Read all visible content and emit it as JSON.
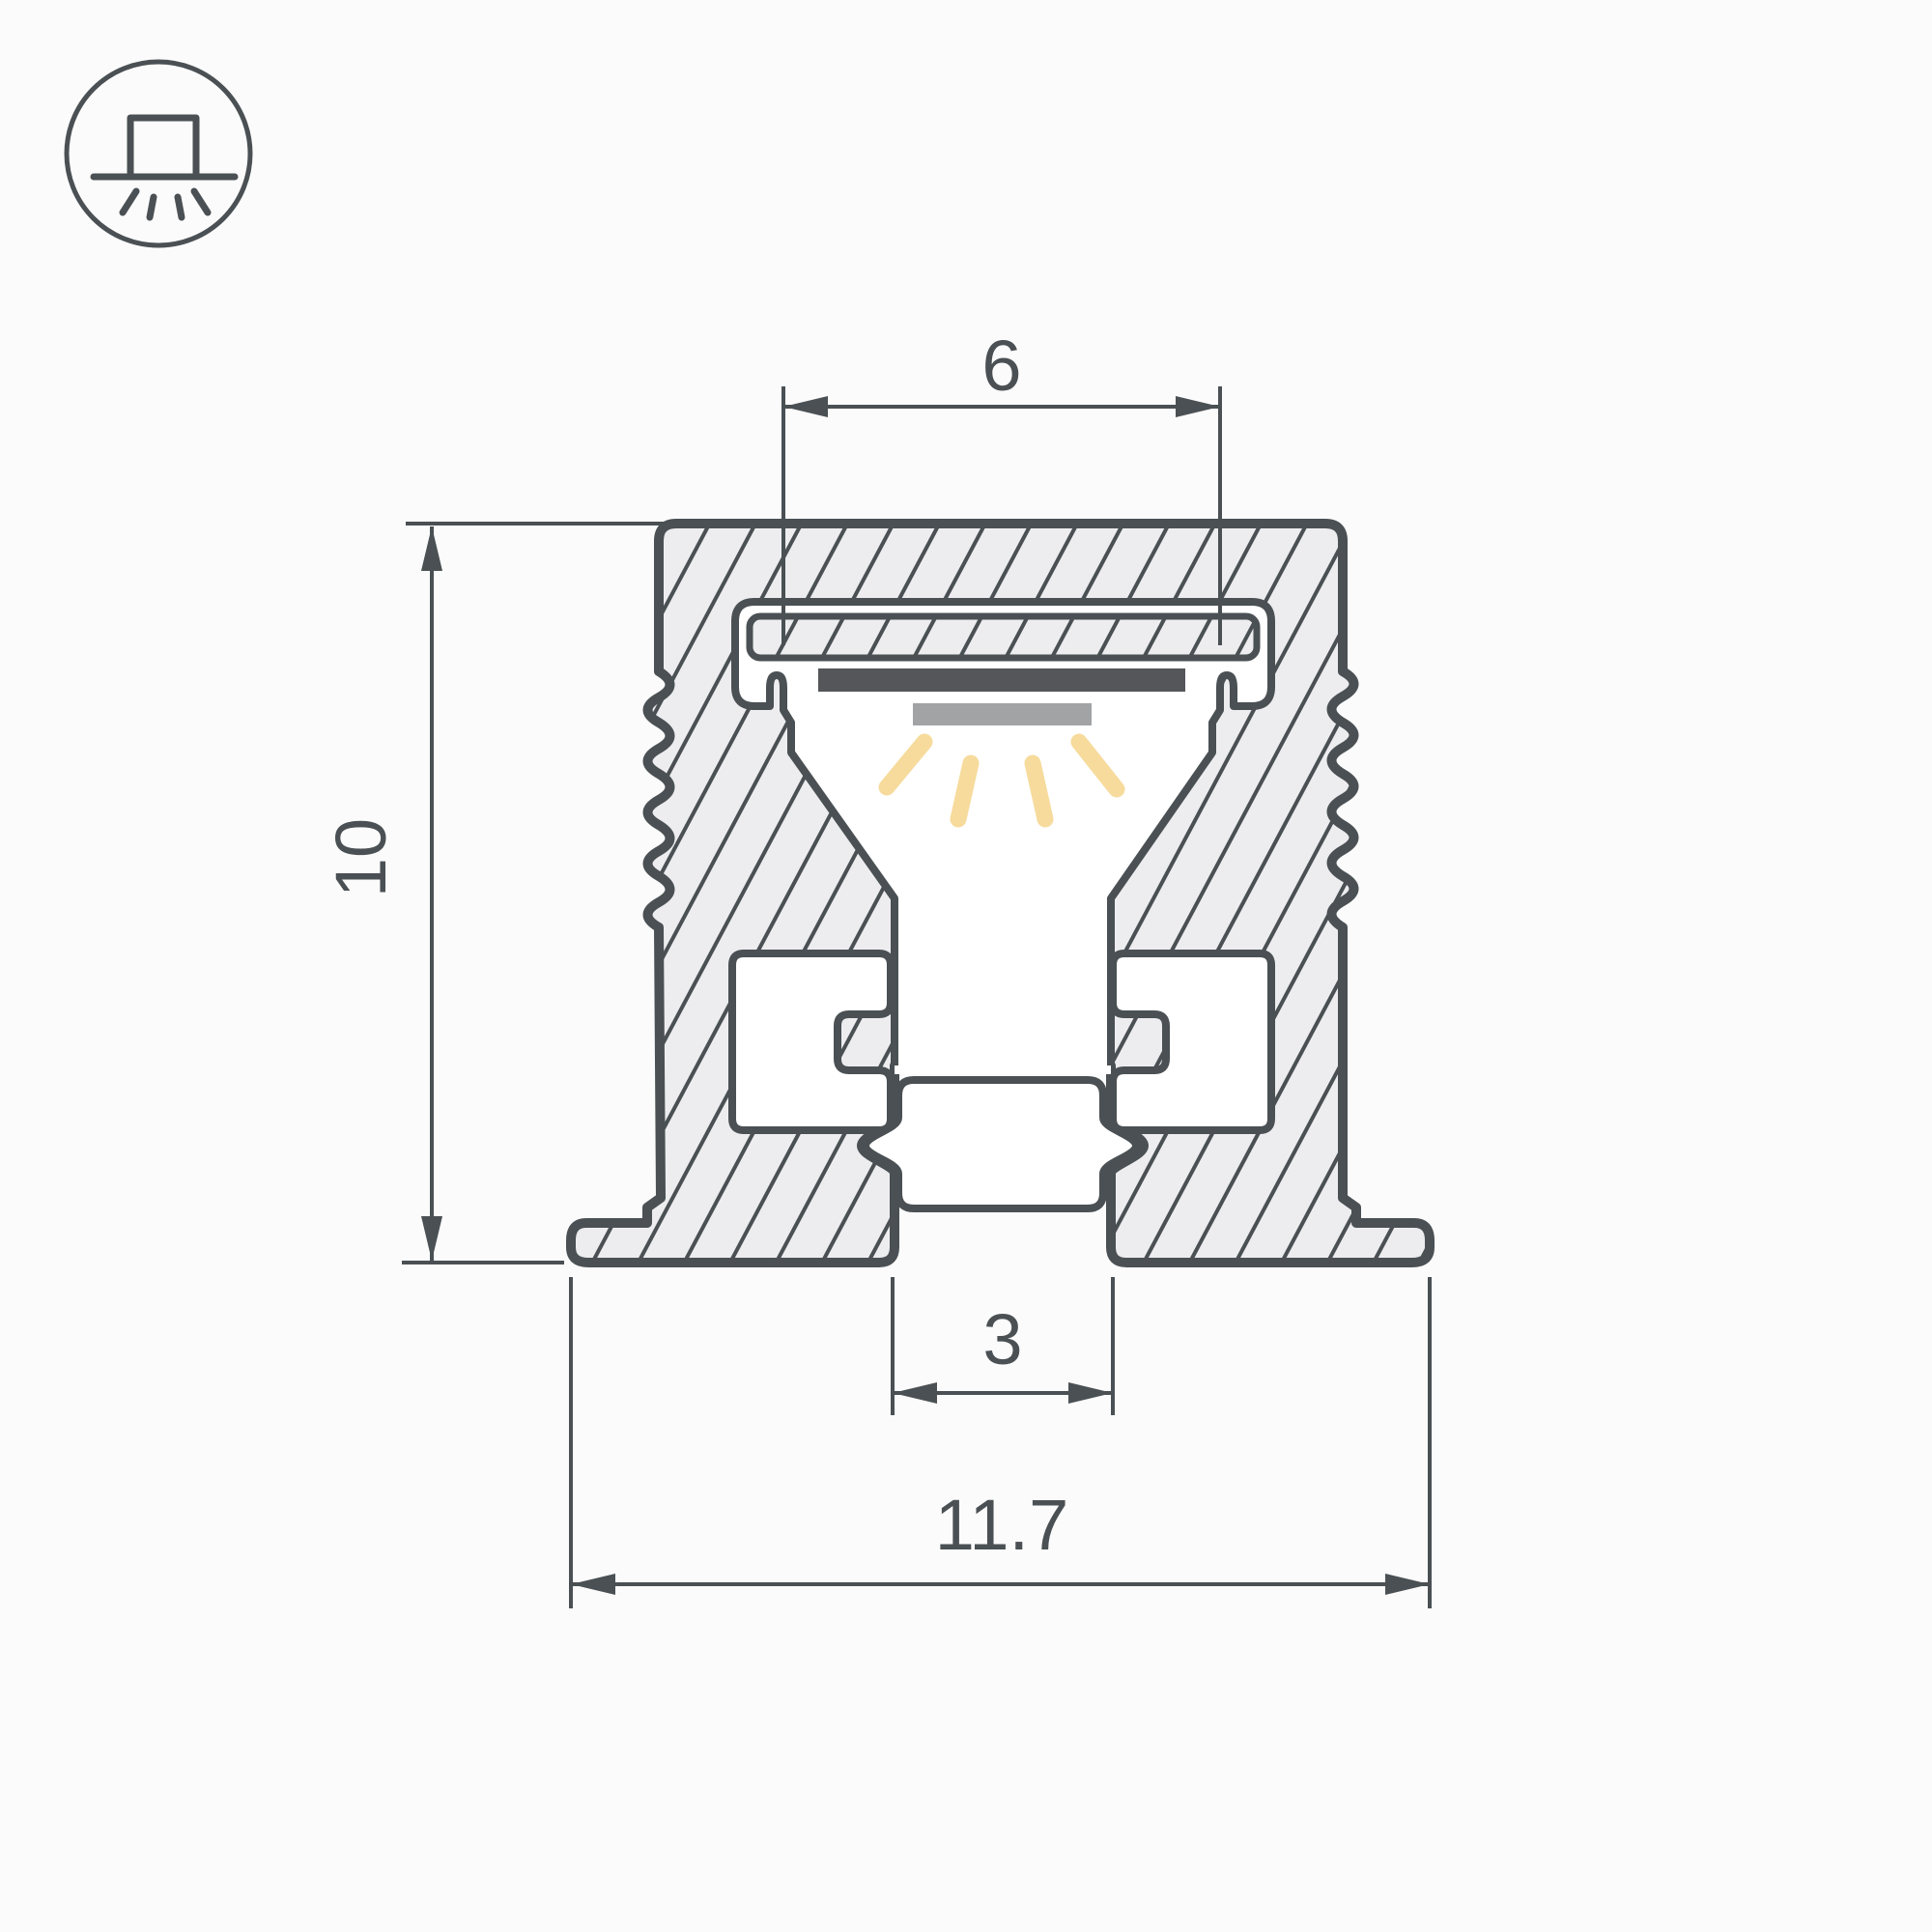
{
  "page": {
    "background": "#FBFBFB"
  },
  "colors": {
    "bg": "#FBFBFB",
    "line": "#4A5053",
    "body": "#EDEDEF",
    "white": "#FFFFFF",
    "pcb": "#54565A",
    "led": "#A2A3A5",
    "ray": "#F6DB9C"
  },
  "icon": {
    "name": "surface-mount-downlight-icon",
    "meaning": "profile mounted on surface, light emitted downward"
  },
  "drawing": {
    "type": "technical-cross-section",
    "subject": "aluminium LED profile with diffuser plate, LED strip and bottom groove"
  },
  "dimensions": {
    "slot_width": {
      "label": "6"
    },
    "height": {
      "label": "10"
    },
    "groove_width": {
      "label": "3"
    },
    "overall_width": {
      "label": "11.7"
    }
  }
}
